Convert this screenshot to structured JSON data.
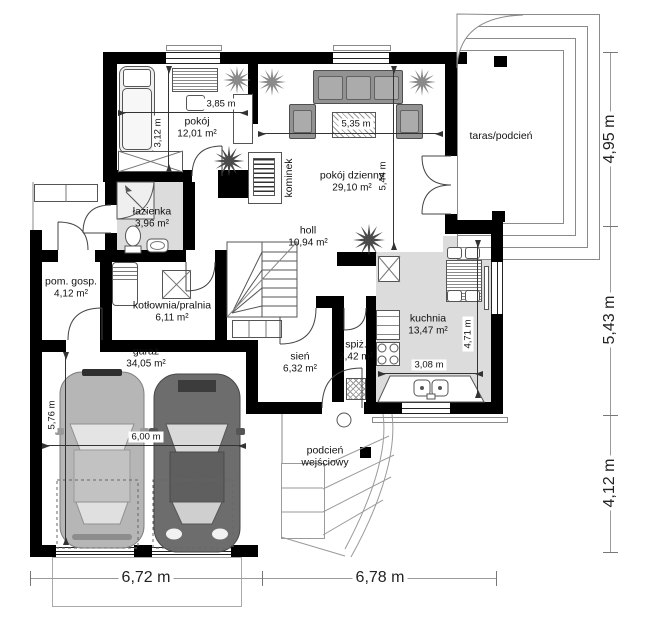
{
  "plan": {
    "rooms": {
      "pokoj": {
        "name": "pokój",
        "area": "12,01 m²"
      },
      "living": {
        "name": "pokój dzienny",
        "area": "29,10 m²"
      },
      "bathroom": {
        "name": "łazienka",
        "area": "3,96 m²"
      },
      "utility": {
        "name": "pom. gosp.",
        "area": "4,12 m²"
      },
      "boiler": {
        "name": "kotłownia/pralnia",
        "area": "6,11 m²"
      },
      "garage": {
        "name": "garaż",
        "area": "34,05 m²"
      },
      "hall": {
        "name": "holl",
        "area": "10,94 m²"
      },
      "vestibule": {
        "name": "sień",
        "area": "6,32 m²"
      },
      "pantry": {
        "name": "spiż.",
        "area": "2,42 m²"
      },
      "kitchen": {
        "name": "kuchnia",
        "area": "13,47 m²"
      },
      "fireplace": {
        "name": "kominek"
      },
      "terrace": {
        "name": "taras/podcień"
      },
      "porch": {
        "line1": "podcień",
        "line2": "wejściowy"
      }
    },
    "dimensions": {
      "pokoj_width": "3,85 m",
      "pokoj_height": "3,12 m",
      "living_width": "5,35 m",
      "living_height": "5,44 m",
      "kitchen_width": "3,08 m",
      "kitchen_height": "4,71 m",
      "garage_width": "6,00 m",
      "garage_height": "5,76 m",
      "right_top": "4,95 m",
      "right_middle": "5,43 m",
      "right_bottom": "4,12 m",
      "bottom_left": "6,72 m",
      "bottom_right": "6,78 m"
    },
    "colors": {
      "wall": "#000000",
      "floor_accent": "#dcdcdc",
      "car_light": "#b6b6b6",
      "car_dark": "#6d6d6d"
    }
  }
}
